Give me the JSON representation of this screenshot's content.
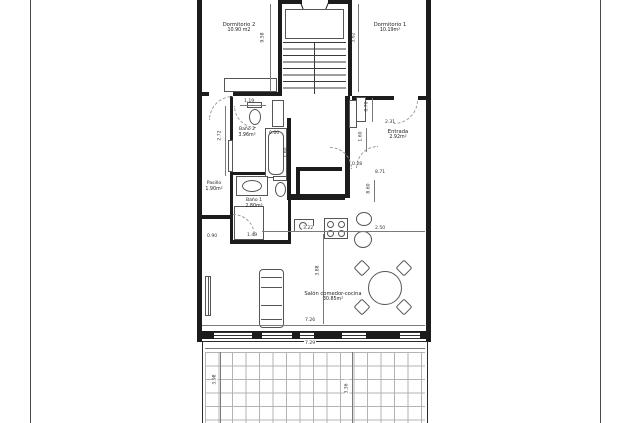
{
  "rooms": {
    "dormitorio2": {
      "name": "Dormitorio 2",
      "area": "10.90 m2"
    },
    "dormitorio1": {
      "name": "Dormitorio 1",
      "area": "10.19m²"
    },
    "bano2": {
      "name": "Baño 2",
      "area": "3.96m²"
    },
    "pasillo": {
      "name": "Pasillo",
      "area": "1.90m²"
    },
    "bano1": {
      "name": "Baño 1",
      "area": "2.80m²"
    },
    "entrada": {
      "name": "Entrada",
      "area": "2.92m²"
    },
    "salon": {
      "name": "Salón comedor-cocina",
      "area": "30.85m²"
    }
  },
  "dimensions": {
    "stair_left_v": "9.58",
    "stair_right_v": "3.62",
    "bano2_top": "1.19",
    "bano2_left_v": "2.72",
    "bano2_width": "0.60",
    "bano2_right_v": "1.60",
    "entrada_top_v": "0.70",
    "entrada_width": "2.31",
    "entrada_left_v": "1.60",
    "entrada_gap": "0.28",
    "entrada_total": "8.71",
    "entrada_right_v": "8.60",
    "salon_left": "0.90",
    "bano1_bottom": "1.49",
    "kitchen_left": "3.22",
    "kitchen_right": "2.50",
    "salon_mid_v": "3.88",
    "salon_width": "7.26",
    "terrace_width": "7.29",
    "terrace_left_v": "3.98",
    "terrace_mid_v": "3.36"
  },
  "colors": {
    "wall": "#1c1c1c",
    "line": "#555555",
    "dim_text": "#333333",
    "grid": "#b3b3b3"
  }
}
